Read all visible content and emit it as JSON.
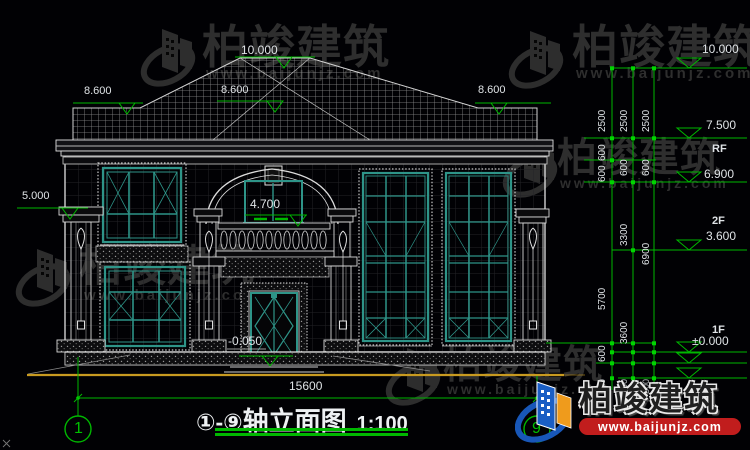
{
  "colors": {
    "green": "#00b800",
    "teal": "#2e9488",
    "white_line": "#d8d8d8",
    "yellow": "#c89a20",
    "wm_gray": "#2e2e2e",
    "logo_blue": "#1a5ec4",
    "logo_orange": "#ef9b1c",
    "banner_red": "#c11d1d"
  },
  "watermark": {
    "brand": "柏竣建筑",
    "url": "www.baijunjz.com"
  },
  "logo": {
    "brand": "柏竣建筑",
    "url": "www.baijunjz.com"
  },
  "title": {
    "axis_range": "①-⑨",
    "name": "轴立面图",
    "scale": "1:100"
  },
  "axes": {
    "left": "1",
    "right": "9"
  },
  "labels": [
    {
      "n": "elev-ridge",
      "t": "10.000",
      "x": 241,
      "y": 44,
      "s": 12,
      "c": "w"
    },
    {
      "n": "elev-eave-left",
      "t": "8.600",
      "x": 84,
      "y": 86,
      "s": 11,
      "c": "w"
    },
    {
      "n": "elev-eave-mid",
      "t": "8.600",
      "x": 221,
      "y": 85,
      "s": 11,
      "c": "w"
    },
    {
      "n": "elev-eave-right",
      "t": "8.600",
      "x": 478,
      "y": 85,
      "s": 11,
      "c": "w"
    },
    {
      "n": "elev-porch",
      "t": "5.000",
      "x": 22,
      "y": 191,
      "s": 11,
      "c": "w"
    },
    {
      "n": "elev-balcony-win",
      "t": "4.700",
      "x": 250,
      "y": 198,
      "s": 12,
      "c": "w"
    },
    {
      "n": "elev-entry",
      "t": "-0.050",
      "x": 228,
      "y": 335,
      "s": 12,
      "c": "w"
    },
    {
      "n": "dim-total-width",
      "t": "15600",
      "x": 289,
      "y": 380,
      "s": 12,
      "c": "w"
    },
    {
      "n": "elev-r-10000",
      "t": "10.000",
      "x": 702,
      "y": 43,
      "s": 12,
      "c": "w"
    },
    {
      "n": "elev-r-7500",
      "t": "7.500",
      "x": 706,
      "y": 119,
      "s": 12,
      "c": "w"
    },
    {
      "n": "floor-rf",
      "t": "RF",
      "x": 712,
      "y": 144,
      "s": 11,
      "c": "w",
      "b": 1
    },
    {
      "n": "elev-r-6900",
      "t": "6.900",
      "x": 704,
      "y": 168,
      "s": 12,
      "c": "w"
    },
    {
      "n": "floor-2f",
      "t": "2F",
      "x": 712,
      "y": 216,
      "s": 11,
      "c": "w",
      "b": 1
    },
    {
      "n": "elev-r-3600",
      "t": "3.600",
      "x": 706,
      "y": 230,
      "s": 12,
      "c": "w"
    },
    {
      "n": "floor-1f",
      "t": "1F",
      "x": 712,
      "y": 325,
      "s": 11,
      "c": "w",
      "b": 1
    },
    {
      "n": "elev-r-0000",
      "t": "±0.000",
      "x": 692,
      "y": 335,
      "s": 12,
      "c": "w"
    },
    {
      "n": "dim-2500-a",
      "t": "2500",
      "x": 598,
      "y": 132,
      "s": 10,
      "c": "w",
      "r": 1
    },
    {
      "n": "dim-2500-b",
      "t": "2500",
      "x": 620,
      "y": 132,
      "s": 10,
      "c": "w",
      "r": 1
    },
    {
      "n": "dim-2500-c",
      "t": "2500",
      "x": 642,
      "y": 132,
      "s": 10,
      "c": "w",
      "r": 1
    },
    {
      "n": "dim-600-a1",
      "t": "600",
      "x": 598,
      "y": 161,
      "s": 10,
      "c": "w",
      "r": 1
    },
    {
      "n": "dim-600-a2",
      "t": "600",
      "x": 598,
      "y": 182,
      "s": 10,
      "c": "w",
      "r": 1
    },
    {
      "n": "dim-600-b1",
      "t": "600",
      "x": 620,
      "y": 176,
      "s": 10,
      "c": "w",
      "r": 1
    },
    {
      "n": "dim-600-c1",
      "t": "600",
      "x": 642,
      "y": 176,
      "s": 10,
      "c": "w",
      "r": 1
    },
    {
      "n": "dim-3300",
      "t": "3300",
      "x": 620,
      "y": 246,
      "s": 10,
      "c": "w",
      "r": 1
    },
    {
      "n": "dim-5700",
      "t": "5700",
      "x": 598,
      "y": 310,
      "s": 10,
      "c": "w",
      "r": 1
    },
    {
      "n": "dim-6900",
      "t": "6900",
      "x": 642,
      "y": 265,
      "s": 10,
      "c": "w",
      "r": 1
    },
    {
      "n": "dim-3600",
      "t": "3600",
      "x": 620,
      "y": 344,
      "s": 10,
      "c": "w",
      "r": 1
    },
    {
      "n": "dim-600-a3",
      "t": "600",
      "x": 598,
      "y": 362,
      "s": 10,
      "c": "w",
      "r": 1
    },
    {
      "n": "dim-300-a",
      "t": "300",
      "x": 598,
      "y": 394,
      "s": 9,
      "c": "gy",
      "r": 1
    },
    {
      "n": "dim-300-b",
      "t": "300",
      "x": 620,
      "y": 394,
      "s": 9,
      "c": "gy",
      "r": 1
    },
    {
      "n": "dim-300-c",
      "t": "300",
      "x": 642,
      "y": 394,
      "s": 9,
      "c": "gy",
      "r": 1
    },
    {
      "n": "axis-1-number",
      "t": "1",
      "x": 74,
      "y": 421,
      "s": 16,
      "c": "g"
    },
    {
      "n": "axis-9-number",
      "t": "9",
      "x": 532,
      "y": 421,
      "s": 16,
      "c": "g"
    }
  ]
}
